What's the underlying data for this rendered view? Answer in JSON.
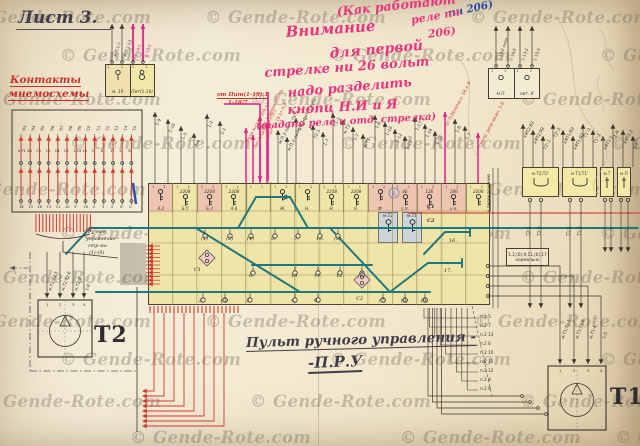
{
  "sheet_title": "Лист 3.",
  "watermark": "© Gende-Rote.com",
  "left_heading": [
    "Контакты",
    "мнемосхемы"
  ],
  "pink_notes": [
    "(Как работают",
    "реле пч",
    "206)",
    "Внимание",
    "для первой",
    "стрелке ни 26 вольт",
    "надо разделить",
    "кнопц Н.И и Я",
    "(выдано реле и отд. стрелка)"
  ],
  "blue_note": "пч 206)",
  "feed_note": [
    "от Пит(1-19):1",
    "1-18/7"
  ],
  "manual_note": [
    "Ручное",
    "управление",
    "стр-ми",
    "(1)-(9)"
  ],
  "caption": [
    "Пульт ручного управления -",
    "-П.Р.У"
  ],
  "small_box_left": {
    "wires": [
      "м.П.1:7",
      "м.П.1:13",
      "1-18/1",
      "1-18/2"
    ],
    "cells": [
      "м. 19",
      "Пит(1-19)"
    ],
    "terms": "1 2"
  },
  "small_box_right": {
    "wires": [
      "1-15/2 кноп",
      "1-16/2",
      "1-13:2",
      "1-15/3"
    ],
    "cells": [
      "Н.П.",
      "пит. Я"
    ]
  },
  "left_box": {
    "tops": [
      "'03",
      "'04",
      "'05",
      "'06",
      "'07",
      "'08",
      "'09",
      "'10",
      "'11",
      "'12",
      "'13",
      "'14",
      "'15"
    ],
    "mids": [
      "п.Т1",
      "5А",
      "С1",
      "С1",
      "С4",
      "С2",
      "1-19",
      "13",
      "2",
      "8",
      "17",
      "2",
      "6"
    ],
    "bottoms": [
      "18",
      "13",
      "18",
      "13",
      "11",
      "10",
      "5",
      "16",
      "4",
      "3",
      "2",
      "6",
      "0"
    ]
  },
  "top_wires": [
    "1-9",
    "1-10",
    "1-3",
    "1-4",
    "1-2",
    "1-1",
    "Реле м-схем 2(А;+)",
    "Пит 1/1и13:1и3/3(-)",
    "Пит. стрелок (1)-(9)",
    "Пит 15-18 от П.Р",
    "м.П.2 пит 1 путь",
    "м.П.2 пит 2 путь",
    "м.П.1 пит 3 путь",
    "Т2:3",
    "1-7",
    "Т1:3",
    "м.Т2",
    "1-7",
    "м.Т1",
    "1-8",
    "1-18",
    "1-12",
    "1-13",
    "1-17",
    "1-16",
    "1-10",
    "от П.безопасн. 2А и Ф",
    "1-8",
    "1-7",
    "смотр. реле важн. 1-8"
  ],
  "right_wires": [
    "кЯТ2:В2",
    "кЯТ2;Я2",
    "Т2':1",
    "Т2':2",
    "кЯТ1;В2",
    "кЯТ1;Я2",
    "Т1':1",
    "Т1':2",
    "кЯТ1:1",
    "2-Я",
    "кЯТ1:2",
    "3-7"
  ],
  "panel": {
    "cell_terms": "1 2",
    "cells": [
      {
        "t": "",
        "n": "А.2",
        "tint": "rose",
        "key": 1
      },
      {
        "t": "2208",
        "n": "Б.5",
        "tint": "",
        "key": 1
      },
      {
        "t": "2208",
        "n": "Б.3",
        "tint": "rose",
        "key": 1
      },
      {
        "t": "2208",
        "n": "А.6",
        "tint": "",
        "key": 1
      },
      {
        "t": "",
        "n": "",
        "tint": "",
        "key": 0
      },
      {
        "t": "",
        "n": "Ж.",
        "tint": "",
        "key": 1
      },
      {
        "t": "",
        "n": "Н.",
        "tint": "",
        "key": 1
      },
      {
        "t": "2208",
        "n": "Н.",
        "tint": "",
        "key": 1
      },
      {
        "t": "2208",
        "n": "9.",
        "tint": "",
        "key": 1
      },
      {
        "t": "",
        "n": "Ф.",
        "tint": "rose",
        "key": 1
      },
      {
        "t": "4Б",
        "n": "у.п.",
        "tint": "rose",
        "key": 1
      },
      {
        "t": "12Б",
        "n": "9.",
        "tint": "rose",
        "key": 1
      },
      {
        "t": "19Б",
        "n": "у.я.",
        "tint": "rose",
        "key": 1
      },
      {
        "t": "2208",
        "n": "",
        "tint": "",
        "key": 1
      }
    ],
    "gray": [
      "м.Т2",
      "м.Т1"
    ],
    "lamps_upper": [
      "(1)",
      "(2)",
      "(4)",
      "5.",
      "7.",
      "13.",
      "(5)"
    ],
    "lamps_middle": [
      "6.",
      "10.",
      "11.",
      "12.",
      "(6)"
    ],
    "lamps_bottom": [
      "2.",
      "(3)",
      "3.",
      "4.",
      "9.",
      "(7)",
      "(8)",
      "(9)"
    ],
    "stubs": [
      "16.",
      "17."
    ],
    "c1": "С1",
    "c2": "С2",
    "vert_note": "к переключению"
  },
  "right_boxes": {
    "labels": [
      "м.Т2;Т2'",
      "м.Т1;Т1'",
      "м.Т",
      "м.П"
    ],
    "outputs": [
      "Т2:1",
      "Т2:2",
      "Т1:1",
      "Т1:2"
    ]
  },
  "normal_box": {
    "l1": "1,2,(6),9,11,(6),17",
    "l2": "нормально"
  },
  "ladder": [
    "п.2 5",
    "п.2 7",
    "п.2 13",
    "п.2 6",
    "п.2 10",
    "п.2 11",
    "п.2 12",
    "п.2 8",
    "п.2 9"
  ],
  "t2": {
    "label": "Т2",
    "terminals": [
      "1",
      "2",
      "3",
      "4"
    ],
    "wires": [
      "м.Т2;Т2:5",
      "м.Т2;Т2:6",
      "м.Т2:3",
      "1-6"
    ]
  },
  "t1": {
    "label": "Т1",
    "terminals": [
      "1",
      "2",
      "3",
      "4"
    ],
    "wires": [
      "м.Т1;Т1:5",
      "м.Т1;Т1:6",
      "м.Т1:4",
      "1-5"
    ]
  },
  "colors": {
    "paper": "#f1e7cf",
    "panel": "#f0e5a9",
    "track": "#20777c",
    "red_ink": "#c23c34",
    "pink": "#e0218a"
  }
}
